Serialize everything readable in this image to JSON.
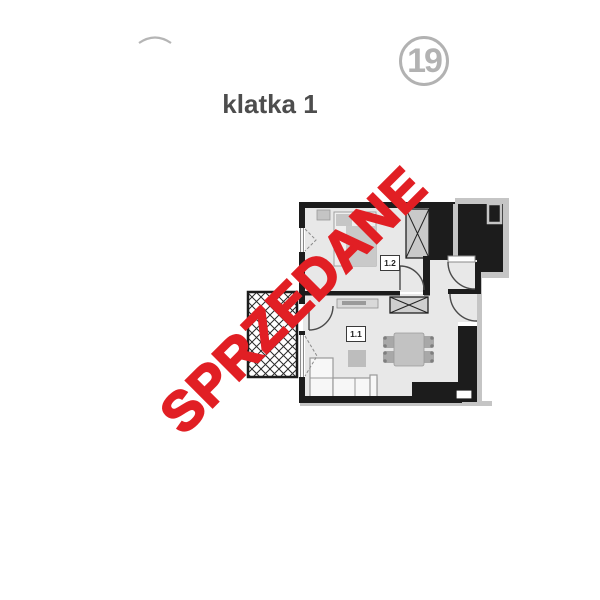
{
  "header": {
    "staircase_label": "klatka 1",
    "unit_number": "19",
    "watermark": "SPRZEDANE"
  },
  "floorplan": {
    "rooms": [
      {
        "label": "1.1"
      },
      {
        "label": "1.2"
      }
    ]
  },
  "colors": {
    "watermark_red": "#e11f24",
    "badge_gray": "#b2b2b2",
    "staircase_text_gray": "#4d4d4d",
    "wall_black": "#1c1c1c",
    "floor_gray": "#e8e8e8",
    "building_outline_gray": "#c5c5c5",
    "furniture_gray": "#c9c9c9"
  }
}
